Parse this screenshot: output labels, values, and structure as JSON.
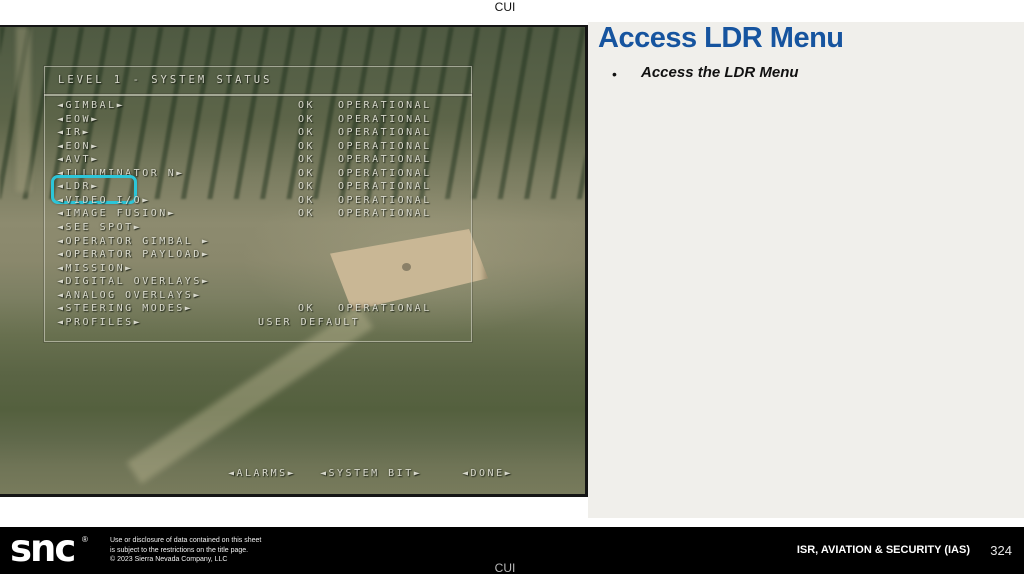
{
  "page": {
    "cui_top": "CUI",
    "cui_bottom": "CUI"
  },
  "slide": {
    "title": "Access LDR Menu",
    "bullet_marker": "•",
    "bullet_text": "Access the LDR Menu"
  },
  "osd": {
    "title": "LEVEL 1 - SYSTEM STATUS",
    "items": [
      {
        "label": "◄GIMBAL►",
        "ok": "OK",
        "status": "OPERATIONAL"
      },
      {
        "label": "◄EOW►",
        "ok": "OK",
        "status": "OPERATIONAL"
      },
      {
        "label": "◄IR►",
        "ok": "OK",
        "status": "OPERATIONAL"
      },
      {
        "label": "◄EON►",
        "ok": "OK",
        "status": "OPERATIONAL"
      },
      {
        "label": "◄AVT►",
        "ok": "OK",
        "status": "OPERATIONAL"
      },
      {
        "label": "◄ILLUMINATOR N►",
        "ok": "OK",
        "status": "OPERATIONAL"
      },
      {
        "label": "◄LDR►",
        "ok": "OK",
        "status": "OPERATIONAL",
        "highlight": true
      },
      {
        "label": "◄VIDEO I/O►",
        "ok": "OK",
        "status": "OPERATIONAL"
      },
      {
        "label": "◄IMAGE FUSION►",
        "ok": "OK",
        "status": "OPERATIONAL"
      },
      {
        "label": "◄SEE SPOT►"
      },
      {
        "label": "◄OPERATOR GIMBAL ►"
      },
      {
        "label": "◄OPERATOR PAYLOAD►"
      },
      {
        "label": "◄MISSION►"
      },
      {
        "label": "◄DIGITAL OVERLAYS►"
      },
      {
        "label": "◄ANALOG OVERLAYS►"
      },
      {
        "label": "◄STEERING MODES►",
        "ok": "OK",
        "status": "OPERATIONAL"
      },
      {
        "label": "◄PROFILES►",
        "value": "USER DEFAULT"
      }
    ],
    "actions": [
      {
        "label": "◄ALARMS►"
      },
      {
        "label": "◄SYSTEM BIT►"
      },
      {
        "label": "◄DONE►"
      }
    ],
    "highlight_color": "#2cc6d9"
  },
  "footer": {
    "logo": "snc",
    "logo_mark": "®",
    "disclaimer_lines": [
      "Use or disclosure of data contained on this sheet",
      "is subject to the restrictions on the title page.",
      "© 2023 Sierra Nevada Company, LLC"
    ],
    "section": "ISR, AVIATION & SECURITY (IAS)",
    "page_number": "324"
  },
  "colors": {
    "title_blue": "#16549f",
    "highlight_cyan": "#2cc6d9"
  }
}
